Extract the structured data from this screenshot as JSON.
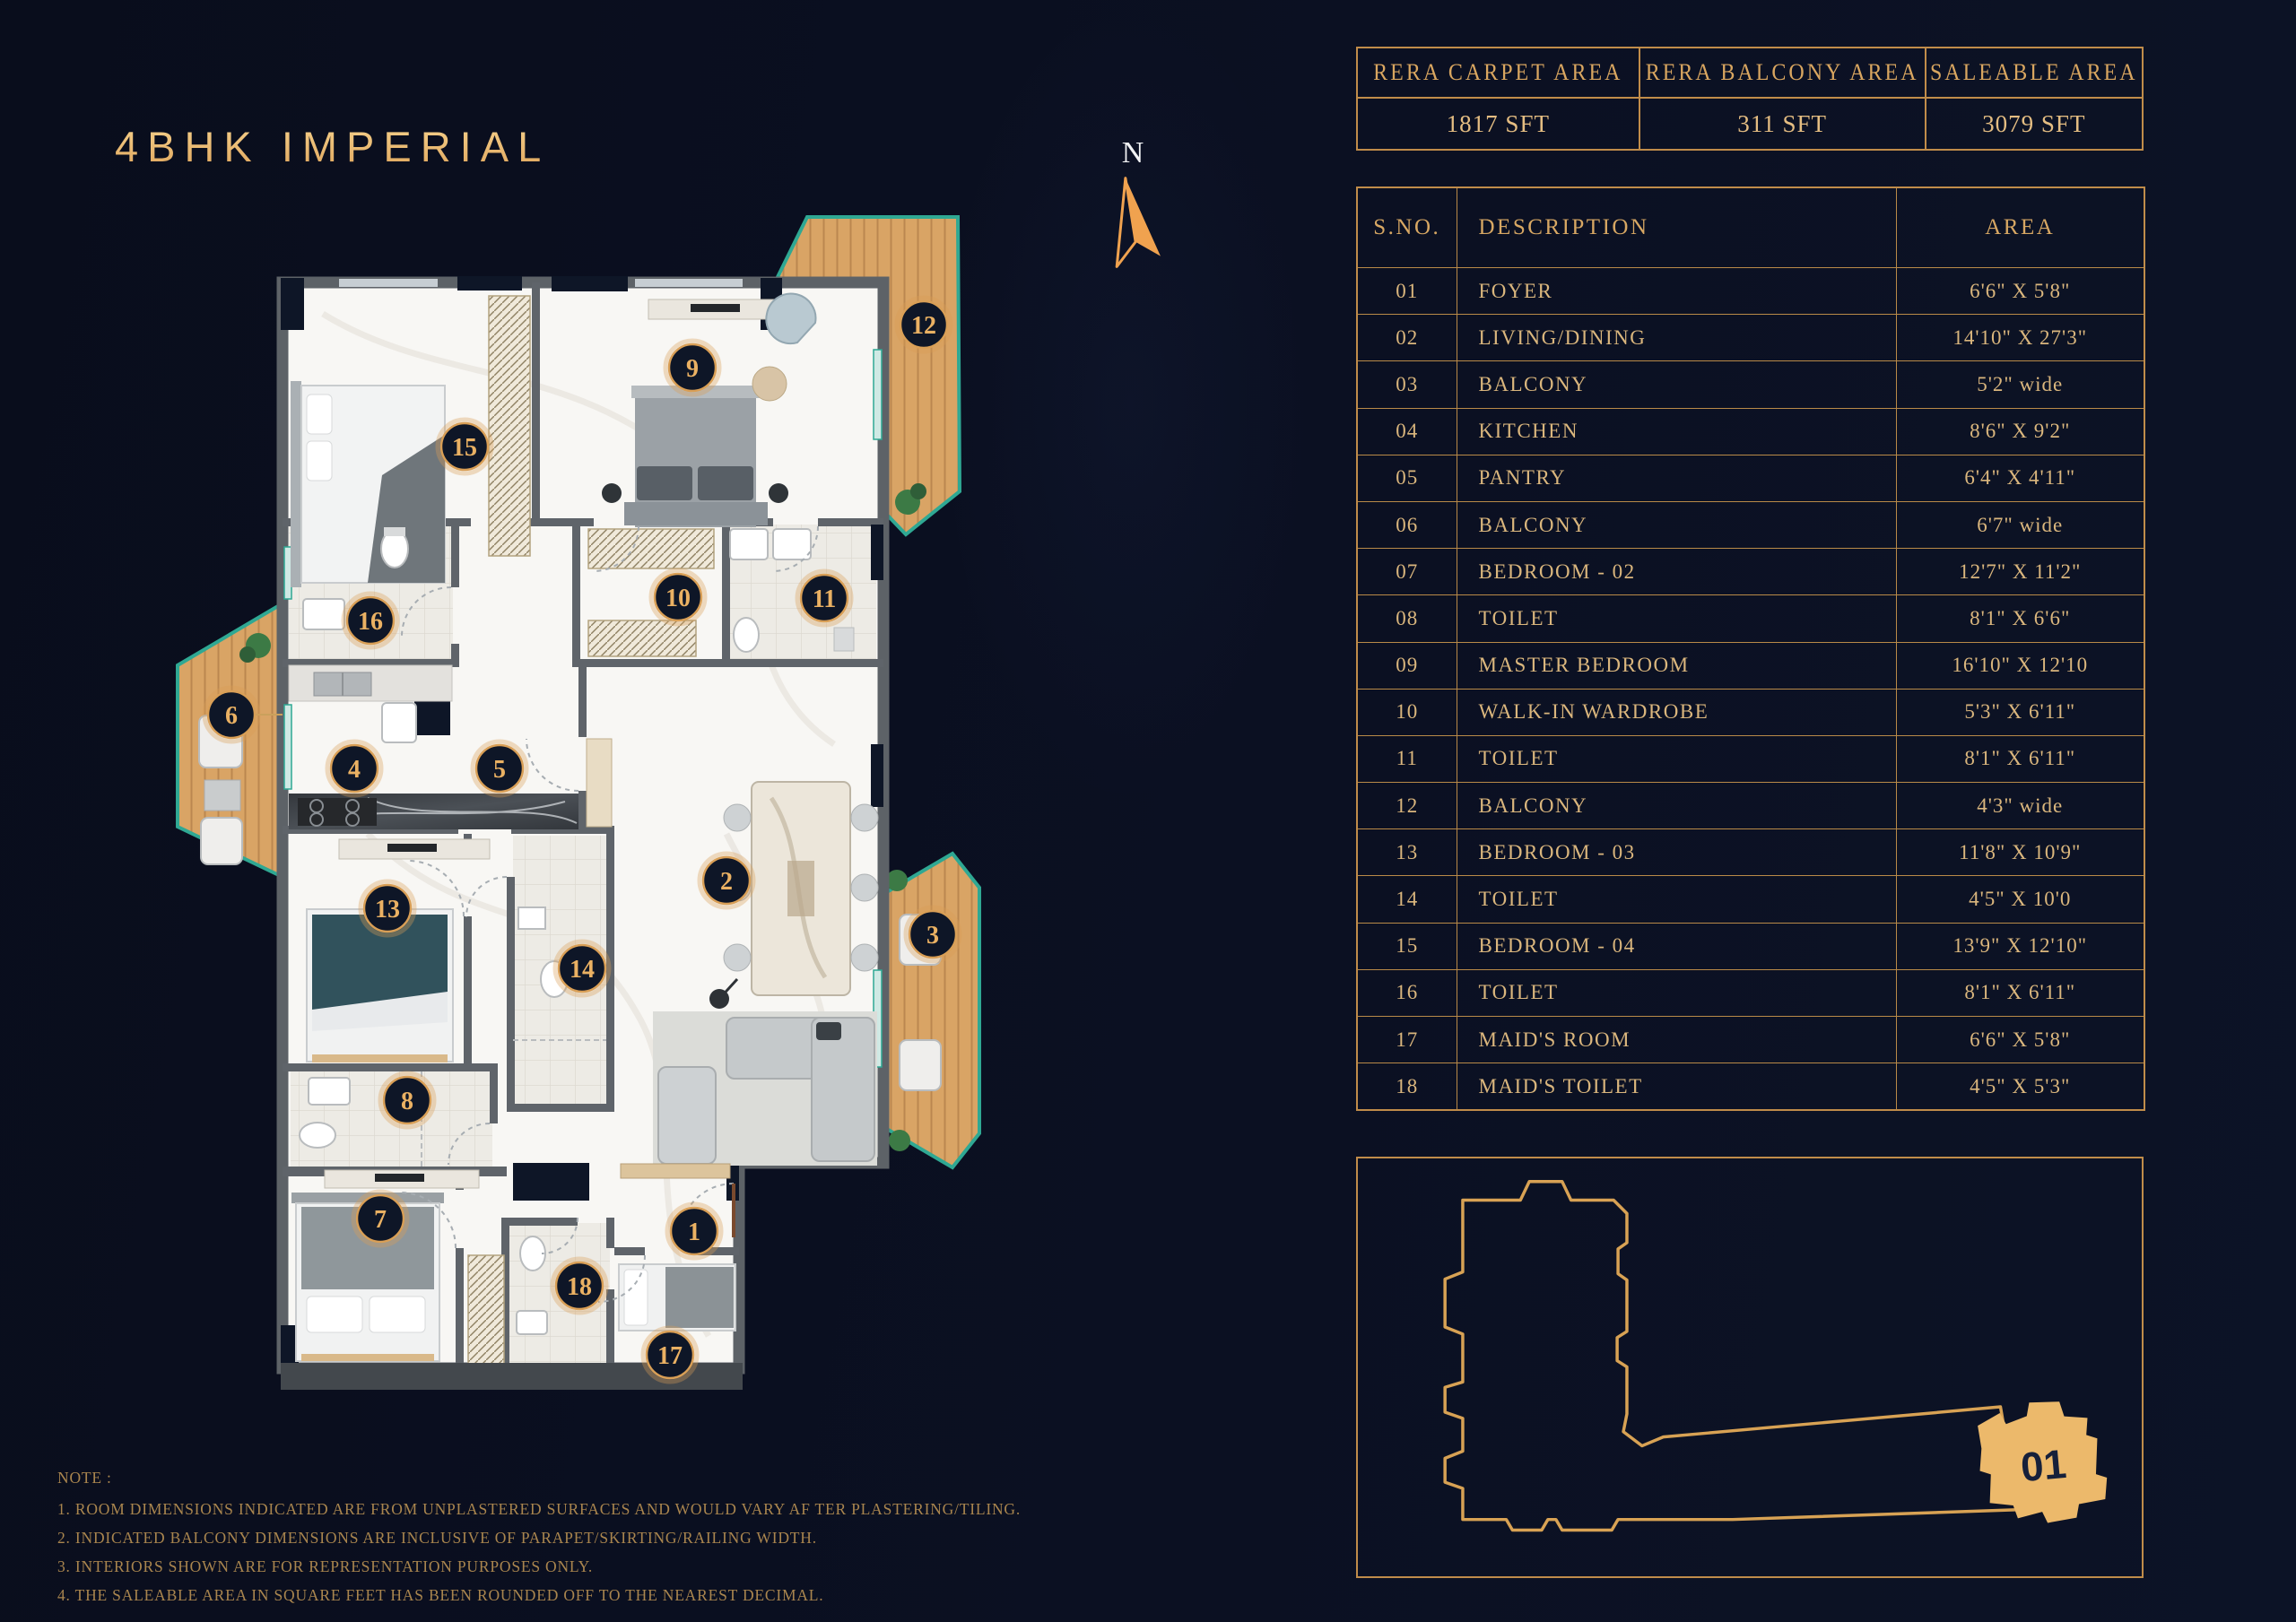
{
  "title": "4BHK IMPERIAL",
  "compass": {
    "label": "N"
  },
  "summary": {
    "cards": [
      {
        "header": "RERA CARPET AREA",
        "value": "1817 SFT"
      },
      {
        "header": "RERA BALCONY AREA",
        "value": "311 SFT"
      },
      {
        "header": "SALEABLE AREA",
        "value": "3079 SFT"
      }
    ]
  },
  "area_table": {
    "headers": [
      "S.NO.",
      "DESCRIPTION",
      "AREA"
    ],
    "rows": [
      [
        "01",
        "FOYER",
        "6'6\" X 5'8\""
      ],
      [
        "02",
        "LIVING/DINING",
        "14'10\" X 27'3\""
      ],
      [
        "03",
        "BALCONY",
        "5'2\" wide"
      ],
      [
        "04",
        "KITCHEN",
        "8'6\" X 9'2\""
      ],
      [
        "05",
        "PANTRY",
        "6'4\" X 4'11\""
      ],
      [
        "06",
        "BALCONY",
        "6'7\" wide"
      ],
      [
        "07",
        "BEDROOM - 02",
        "12'7\" X 11'2\""
      ],
      [
        "08",
        "TOILET",
        "8'1\" X 6'6\""
      ],
      [
        "09",
        "MASTER BEDROOM",
        "16'10\" X 12'10"
      ],
      [
        "10",
        "WALK-IN WARDROBE",
        "5'3\" X 6'11\""
      ],
      [
        "11",
        "TOILET",
        "8'1\" X 6'11\""
      ],
      [
        "12",
        "BALCONY",
        "4'3\" wide"
      ],
      [
        "13",
        "BEDROOM - 03",
        "11'8\" X 10'9\""
      ],
      [
        "14",
        "TOILET",
        "4'5\" X 10'0"
      ],
      [
        "15",
        "BEDROOM - 04",
        "13'9\" X 12'10\""
      ],
      [
        "16",
        "TOILET",
        "8'1\" X 6'11\""
      ],
      [
        "17",
        "MAID'S ROOM",
        "6'6\" X 5'8\""
      ],
      [
        "18",
        "MAID'S TOILET",
        "4'5\" X 5'3\""
      ]
    ]
  },
  "notes": {
    "heading": "NOTE :",
    "items": [
      "1.  ROOM DIMENSIONS INDICATED ARE FROM UNPLASTERED SURFACES AND WOULD VARY AF TER PLASTERING/TILING.",
      "2. INDICATED BALCONY DIMENSIONS ARE INCLUSIVE OF PARAPET/SKIRTING/RAILING WIDTH.",
      "3. INTERIORS SHOWN ARE FOR REPRESENTATION PURPOSES ONLY.",
      "4.  THE SALEABLE AREA IN SQUARE FEET HAS BEEN ROUNDED OFF TO THE NEAREST DECIMAL."
    ]
  },
  "key_plan": {
    "unit_label": "01"
  },
  "plan": {
    "badges": [
      "1",
      "2",
      "3",
      "4",
      "5",
      "6",
      "7",
      "8",
      "9",
      "10",
      "11",
      "12",
      "13",
      "14",
      "15",
      "16",
      "17",
      "18"
    ]
  },
  "colors": {
    "background": "#0b1022",
    "gold_border": "#c08c4a",
    "gold_text": "#dab67d",
    "badge_ring": "#d99f56",
    "badge_fill": "#0e1627",
    "wood_deck": "#d8a263",
    "teal_edge": "#2fa893",
    "floor": "#f8f7f4",
    "wall": "#5d6267"
  }
}
